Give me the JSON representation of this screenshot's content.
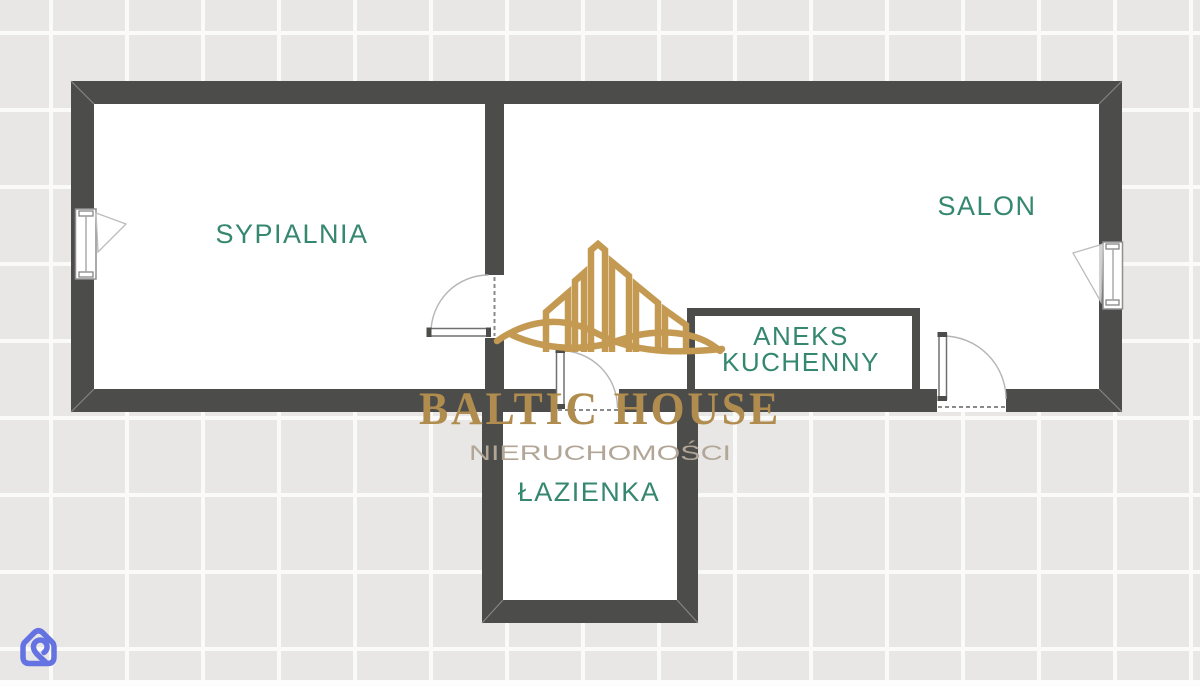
{
  "floorplan": {
    "rooms": [
      {
        "name": "bedroom",
        "label": "SYPIALNIA"
      },
      {
        "name": "living-room",
        "label": "SALON"
      },
      {
        "name": "kitchenette",
        "label_line1": "ANEKS",
        "label_line2": "KUCHENNY"
      },
      {
        "name": "bathroom",
        "label": "ŁAZIENKA"
      }
    ],
    "features": {
      "windows": 2,
      "door_swings": 3
    }
  },
  "watermark": {
    "brand": "BALTIC HOUSE",
    "tagline": "NIERUCHOMOŚCI",
    "icon": "building-skyline-with-waves-icon"
  },
  "branding_corner": {
    "icon": "otodom-house-icon"
  },
  "colors": {
    "wall": "#4c4c4b",
    "floor": "#ffffff",
    "label_teal": "#35876f",
    "logo_gold": "#b08c4e",
    "logo_gold_icon": "#c49a53",
    "tagline_gray": "#b2a697",
    "portal_blue": "#6472e2",
    "tile": "#e8e7e6",
    "grout": "#fafaf9"
  }
}
